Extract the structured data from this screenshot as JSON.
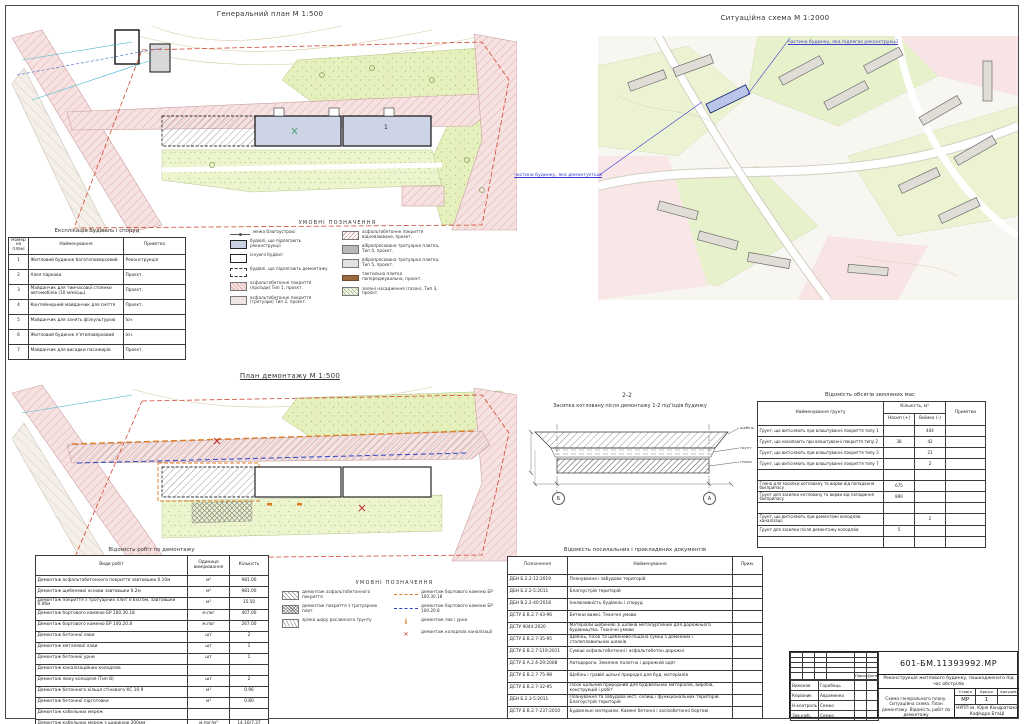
{
  "titles": {
    "general_plan": "Генеральний план М 1:500",
    "situation": "Ситуаційна схема М 1:2000",
    "demolition_plan": "План демонтажу М 1:500"
  },
  "plan_labels": {
    "building_main": "1"
  },
  "situation_notes": {
    "top": "частина будинку, яка підлягає реконструкції",
    "left": "частина будинку, яка демонтується"
  },
  "legend_general": {
    "title": "УМОВНІ ПОЗНАЧЕННЯ",
    "left": [
      {
        "swatch": "sw-boundary",
        "label": "межа благоустрою"
      },
      {
        "swatch": "sw-recon",
        "label": "будівлі, що підлягають реконструкції"
      },
      {
        "swatch": "sw-exist",
        "label": "існуючі будівлі"
      },
      {
        "swatch": "sw-demo",
        "label": "будівлі, що підлягають демонтажу"
      },
      {
        "swatch": "sw-asph1",
        "label": "асфальтобетонне покриття (проїзди) Тип 1, проєкт."
      },
      {
        "swatch": "sw-asph2",
        "label": "асфальтобетонне покриття (тротуари) Тип 2, проєкт."
      }
    ],
    "right": [
      {
        "swatch": "sw-asph-ex",
        "label": "асфальтобетонне покриття відновлюване, проєкт."
      },
      {
        "swatch": "sw-plit4",
        "label": "вібропресована тротуарна плитка, Тип 4, проєкт."
      },
      {
        "swatch": "sw-plit5",
        "label": "вібропресована тротуарна плитка, Тип 5, проєкт."
      },
      {
        "swatch": "sw-tact",
        "label": "тактильна плитка попереджувальна, проєкт."
      },
      {
        "swatch": "sw-green",
        "label": "зелені насадження (газон), Тип 3, проєкт."
      }
    ]
  },
  "legend_demolition": {
    "title": "УМОВНІ ПОЗНАЧЕННЯ",
    "left": [
      {
        "swatch": "sw-dem-asph",
        "label": "демонтаж асфальтобетонного покриття"
      },
      {
        "swatch": "sw-dem-plit",
        "label": "демонтаж покриття з тротуарних плит"
      },
      {
        "swatch": "sw-dem-soil",
        "label": "зрізка шару рослинного ґрунту"
      }
    ],
    "right": [
      {
        "swatch": "sw-dem-bort1",
        "label": "демонтаж бортового каменю БР 100.30.18"
      },
      {
        "swatch": "sw-dem-bort2",
        "label": "демонтаж бортового каменю БР 100.20.8"
      },
      {
        "swatch": "sw-dem-lav",
        "label": "демонтаж лав і урни"
      },
      {
        "swatch": "sw-dem-kol",
        "label": "демонтаж колодязів каналізації"
      }
    ]
  },
  "explication": {
    "title": "Експлікація будівель і споруд",
    "headers": [
      "Номер на плані",
      "Найменування",
      "Примітка"
    ],
    "rows": [
      [
        "1",
        "Житловий будинок багатоповерховий",
        "Реконструкція"
      ],
      [
        "2",
        "Алея паркова",
        "Проєкт."
      ],
      [
        "3",
        "Майданчик для тимчасової стоянки автомобілів (10 м/місць)",
        "Проєкт."
      ],
      [
        "4",
        "Контейнерний майданчик для сміття",
        "Проєкт."
      ],
      [
        "5",
        "Майданчик для занять фізкультурою",
        "Існ."
      ],
      [
        "6",
        "Житловий будинок п'ятиповерховий",
        "Існ."
      ],
      [
        "7",
        "Майданчик для висадки пасажирів",
        "Проєкт."
      ]
    ]
  },
  "works": {
    "title": "Відомість робіт по демонтажу",
    "headers": [
      "Види робіт",
      "Одиниця вимірювання",
      "Кількість"
    ],
    "rows": [
      [
        "Демонтаж асфальтобетонного покриття завтовшки 0.10м",
        "м²",
        "981.00"
      ],
      [
        "Демонтаж щебеневої основи завтовшки 0.2м",
        "м²",
        "981.00"
      ],
      [
        "Демонтаж покриття з тротуарних плит 0.6х0.6м, завтовшки 0.06м",
        "м²",
        "15.50"
      ],
      [
        "Демонтаж бортового каменю БР 100.30.18",
        "м.пог",
        "407.00"
      ],
      [
        "Демонтаж бортового каменю БР 100.20.8",
        "м.пог",
        "267.00"
      ],
      [
        "Демонтаж бетонної лави",
        "шт",
        "2"
      ],
      [
        "Демонтаж металевої лави",
        "шт",
        "1"
      ],
      [
        "Демонтаж бетонної урни",
        "шт",
        "1"
      ],
      [
        "Демонтаж каналізаційних колодязів",
        "",
        ""
      ],
      [
        "Демонтаж люку колодязя (Тип В)",
        "шт",
        "2"
      ],
      [
        "Демонтаж бетонного кільця стінового КС 10.9",
        "м³",
        "0.96"
      ],
      [
        "Демонтаж бетонної підготовки",
        "м³",
        "0.80"
      ],
      [
        "Демонтаж кабельних мереж",
        "",
        ""
      ],
      [
        "Демонтаж кабельних мереж з шириною 200мм",
        "м.пог/м³",
        "14.16/7.37"
      ],
      [
        "Демонтаж бетону під колонами",
        "м³",
        "0.04"
      ]
    ]
  },
  "earthworks": {
    "title": "Відомість обсягів земляних мас",
    "headers": {
      "name": "Найменування ґрунту",
      "qty": "Кількість, м³",
      "nasyp": "Насип (+)",
      "vyimka": "Виїмка (-)",
      "note": "Примітки"
    },
    "rows": [
      [
        "Ґрунт, що витісняють при влаштуванні покриття типу 1",
        "",
        "404",
        ""
      ],
      [
        "Ґрунт, що насипають при влаштуванні покриття типу 2",
        "38",
        "42",
        ""
      ],
      [
        "Ґрунт, що витісняють при влаштуванні покриття типу 3",
        "",
        "21",
        ""
      ],
      [
        "Ґрунт, що витісняють при влаштуванні покриття типу 7",
        "",
        "2",
        ""
      ],
      [
        "",
        "",
        "",
        ""
      ],
      [
        "Глина для засипки котловану та вирви від попадання боєприпасу",
        "675",
        "",
        ""
      ],
      [
        "Ґрунт для засипки котловану та вирви від попадання боєприпасу",
        "890",
        "",
        ""
      ],
      [
        "",
        "",
        "",
        ""
      ],
      [
        "Ґрунт, що витісняють при демонтажі колодязів каналізації",
        "",
        "2",
        ""
      ],
      [
        "Ґрунт для засипки після демонтажу колодязів",
        "5",
        "",
        ""
      ],
      [
        "",
        "",
        "",
        ""
      ]
    ]
  },
  "section": {
    "title": "2-2",
    "subtitle": "Засипка котловану після демонтажу 1-2 під'їздів будинку",
    "axis_left": "Б",
    "axis_right": "А",
    "callouts": [
      "щебінь",
      "ґрунт",
      "глина"
    ]
  },
  "documents": {
    "title": "Відомість посилальних і прикладених документів",
    "headers": [
      "Позначення",
      "Найменування",
      "Прим."
    ],
    "rows": [
      [
        "ДБН Б.2.2-12:2019",
        "Планування і забудова територій",
        ""
      ],
      [
        "ДБН Б.2.2-5:2011",
        "Благоустрій територій",
        ""
      ],
      [
        "ДБН В.2.2-40:2018",
        "Інклюзивність будівель і споруд",
        ""
      ],
      [
        "ДСТУ Б В.2.7-43-96",
        "Бетони важкі. Технічні умови",
        ""
      ],
      [
        "ДСТУ 9044:2020",
        "Матеріали щебеневі зі шлаків металургійних для дорожнього будівництва. Технічні умови",
        ""
      ],
      [
        "ДСТУ Б В.2.7-35-95",
        "Щебінь, пісок та щебенево-піщана суміш з доменних і сталеплавильних шлаків",
        ""
      ],
      [
        "ДСТУ Б В.2.7-119:2011",
        "Суміші асфальтобетонні і асфальтобетон дорожні",
        ""
      ],
      [
        "ДСТУ Б А.2.4-29:2008",
        "Автодороги. Земляне полотно і дорожній одяг",
        ""
      ],
      [
        "ДСТУ Б В.2.7-75-98",
        "Щебінь і гравій щільні природні для буд. матеріалів",
        ""
      ],
      [
        "ДСТУ Б В.2.7-32-95",
        "Пісок щільний природний для будівельних матеріалів, виробів, конструкцій і робіт",
        ""
      ],
      [
        "ДБН Б.2.3-5:2011",
        "Планування та забудова міст, селищ і функціональних територій. Благоустрій територій",
        ""
      ],
      [
        "ДСТУ Б В.2.7-237:2010",
        "Будівельні матеріали. Камені бетонні і залізобетонні бортові",
        ""
      ]
    ]
  },
  "titleblock": {
    "doc_number": "601-БМ.11393992.МР",
    "project_name": "Реконструкція житлового будинку, пошкодженого під час обстрілів",
    "sheet_content": "Схема генерального плану. Ситуаційна схема. План демонтажу. Відомість робіт по демонтажу",
    "org_line1": "НУПП ім. Юрія Кондратюка",
    "org_line2": "Кафедра БтаЦІ",
    "stage_label": "Стадія",
    "sheet_label": "Аркуш",
    "sheets_label": "Аркушів",
    "stage": "МР",
    "sheet_no": "1",
    "sign_label": "Підпис",
    "date_label": "Дата",
    "roles": [
      [
        "Виконав",
        "Горобець",
        "",
        ""
      ],
      [
        "Керівник",
        "Авраменко",
        "",
        ""
      ],
      [
        "Н.контроль",
        "Семко",
        "",
        ""
      ],
      [
        "Зав.каф.",
        "Семко",
        "",
        ""
      ]
    ]
  }
}
